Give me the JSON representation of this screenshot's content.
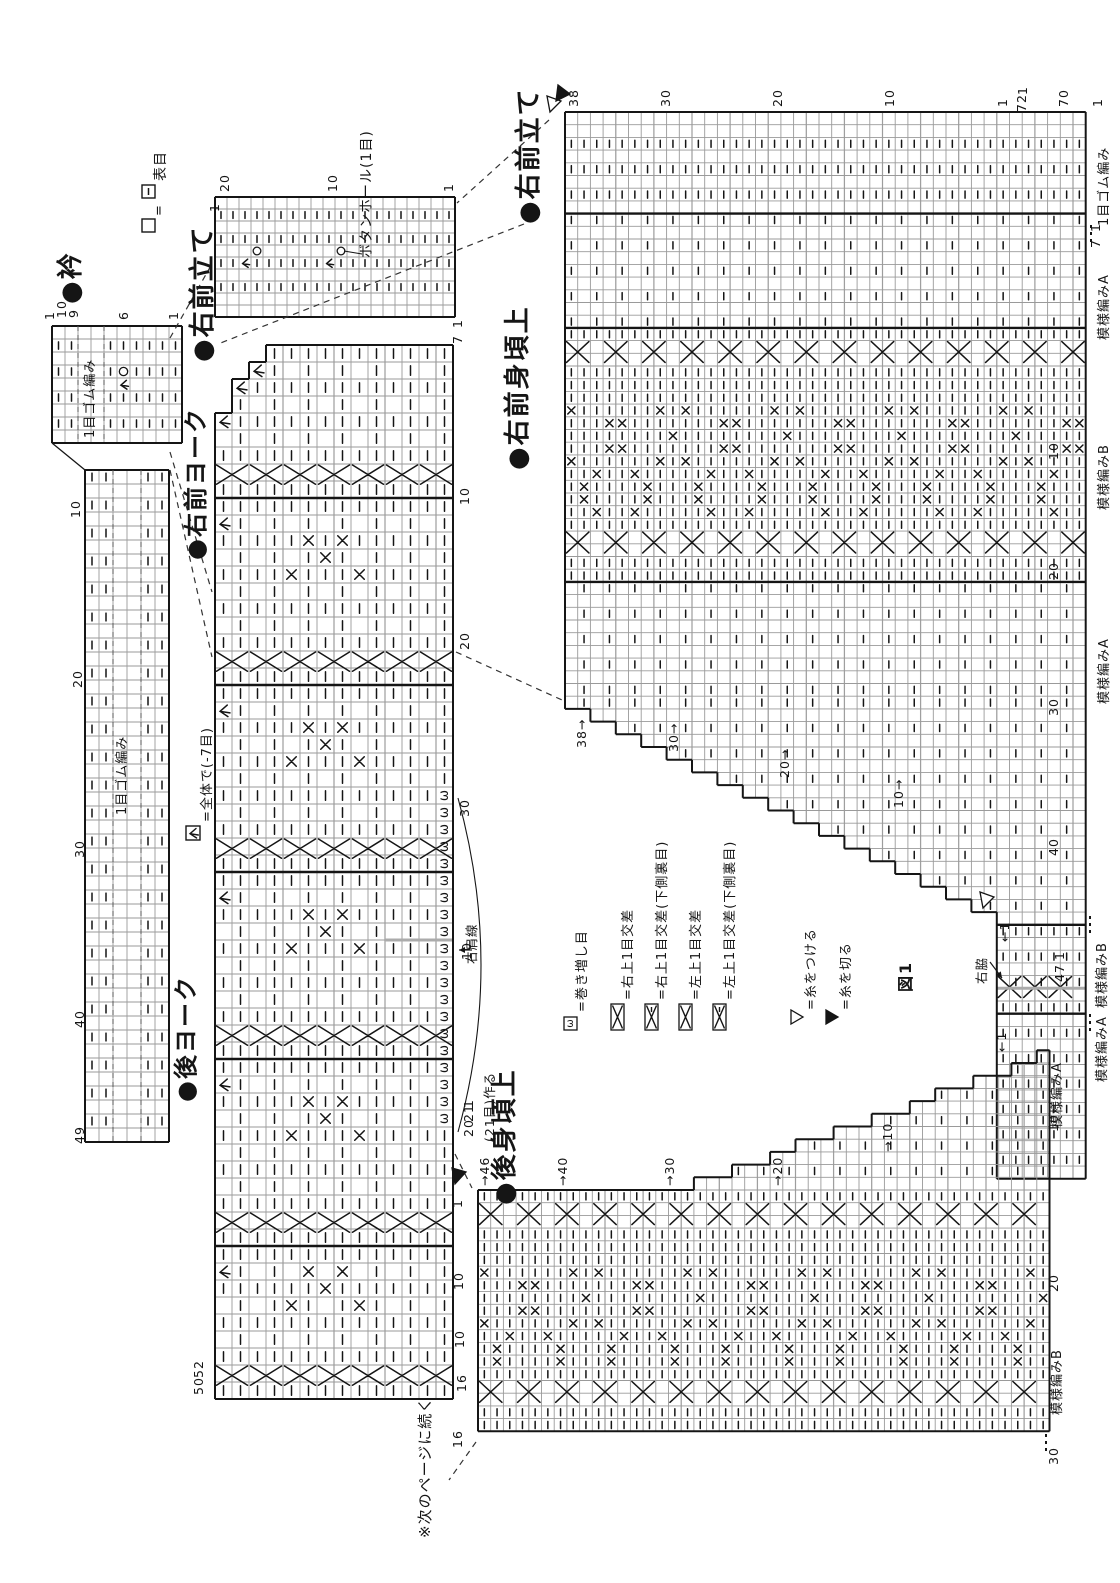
{
  "page": {
    "bg": "#ffffff",
    "ink": "#151515",
    "grid": "#9a9a9a",
    "gray_line": "#bdbdbd",
    "accent_gray": "#b5b5b5"
  },
  "headers": [
    {
      "id": "collar",
      "text": "●衿",
      "x": 58,
      "y": 304,
      "size": 26
    },
    {
      "id": "right-front-band-1",
      "text": "●右前立て",
      "x": 190,
      "y": 362,
      "size": 26
    },
    {
      "id": "right-front-yoke",
      "text": "●右前ヨーク",
      "x": 184,
      "y": 560,
      "size": 24
    },
    {
      "id": "back-yoke",
      "text": "●後ヨーク",
      "x": 174,
      "y": 1102,
      "size": 24
    },
    {
      "id": "right-front-band-2",
      "text": "●右前立て",
      "x": 516,
      "y": 224,
      "size": 26
    },
    {
      "id": "right-front-body-upper",
      "text": "●右前身頃上",
      "x": 505,
      "y": 470,
      "size": 26
    },
    {
      "id": "back-body-upper",
      "text": "●後身頃上",
      "x": 492,
      "y": 1205,
      "size": 26
    }
  ],
  "annotations": [
    {
      "id": "buttonhole",
      "text": "ボタンホール(1目)",
      "x": 360,
      "y": 258,
      "size": 14
    },
    {
      "id": "next-page",
      "text": "※次のページに続く",
      "x": 418,
      "y": 1538,
      "size": 15
    },
    {
      "id": "shoulder-line",
      "text": "右肩線",
      "x": 466,
      "y": 964,
      "size": 12.5
    },
    {
      "id": "make-21",
      "text": "(21目)作る",
      "x": 484,
      "y": 1142,
      "size": 12.5
    },
    {
      "id": "right-side-seam",
      "text": "右脇",
      "x": 976,
      "y": 984,
      "size": 12.5
    },
    {
      "id": "figure-1",
      "text": "図1",
      "x": 898,
      "y": 992,
      "size": 16
    }
  ],
  "section_labels": [
    {
      "text": "1目ゴム編み",
      "x": 1098,
      "y": 226
    },
    {
      "text": "模様編みA",
      "x": 1098,
      "y": 340
    },
    {
      "text": "模様編みB",
      "x": 1098,
      "y": 510
    },
    {
      "text": "模様編みA",
      "x": 1098,
      "y": 704
    },
    {
      "text": "模様編みB",
      "x": 1096,
      "y": 1008
    },
    {
      "text": "模様編みA",
      "x": 1096,
      "y": 1082
    },
    {
      "text": "模様編みA",
      "x": 1051,
      "y": 1128
    },
    {
      "text": "模様編みB",
      "x": 1051,
      "y": 1415
    },
    {
      "text": "1目ゴム編み",
      "x": 84,
      "y": 438
    },
    {
      "text": "1目ゴム編み",
      "x": 116,
      "y": 815
    }
  ],
  "numbers": [
    {
      "t": "1",
      "x": 44,
      "y": 320
    },
    {
      "t": "10",
      "x": 56,
      "y": 318
    },
    {
      "t": "9",
      "x": 68,
      "y": 318
    },
    {
      "t": "6",
      "x": 118,
      "y": 320
    },
    {
      "t": "1",
      "x": 168,
      "y": 320
    },
    {
      "t": "10",
      "x": 70,
      "y": 518
    },
    {
      "t": "20",
      "x": 72,
      "y": 688
    },
    {
      "t": "30",
      "x": 74,
      "y": 858
    },
    {
      "t": "40",
      "x": 74,
      "y": 1028
    },
    {
      "t": "49",
      "x": 74,
      "y": 1144
    },
    {
      "t": "1",
      "x": 209,
      "y": 212
    },
    {
      "t": "20",
      "x": 219,
      "y": 192
    },
    {
      "t": "10",
      "x": 327,
      "y": 192
    },
    {
      "t": "1",
      "x": 443,
      "y": 192
    },
    {
      "t": "1",
      "x": 452,
      "y": 328
    },
    {
      "t": "7",
      "x": 452,
      "y": 344
    },
    {
      "t": "10",
      "x": 459,
      "y": 505
    },
    {
      "t": "20",
      "x": 459,
      "y": 650
    },
    {
      "t": "30",
      "x": 459,
      "y": 817
    },
    {
      "t": "10",
      "x": 461,
      "y": 960
    },
    {
      "t": "1",
      "x": 463,
      "y": 1108
    },
    {
      "t": "21",
      "x": 463,
      "y": 1122
    },
    {
      "t": "20",
      "x": 463,
      "y": 1137
    },
    {
      "t": "52",
      "x": 193,
      "y": 1378
    },
    {
      "t": "50",
      "x": 193,
      "y": 1395
    },
    {
      "t": "38",
      "x": 568,
      "y": 107
    },
    {
      "t": "30",
      "x": 660,
      "y": 107
    },
    {
      "t": "20",
      "x": 772,
      "y": 107
    },
    {
      "t": "10",
      "x": 884,
      "y": 107
    },
    {
      "t": "1",
      "x": 997,
      "y": 107
    },
    {
      "t": "1",
      "x": 1017,
      "y": 95
    },
    {
      "t": "72",
      "x": 1016,
      "y": 112
    },
    {
      "t": "70",
      "x": 1058,
      "y": 107
    },
    {
      "t": "1",
      "x": 1092,
      "y": 107
    },
    {
      "t": "1",
      "x": 1090,
      "y": 232
    },
    {
      "t": "7",
      "x": 1090,
      "y": 248
    },
    {
      "t": "10",
      "x": 1048,
      "y": 460
    },
    {
      "t": "20",
      "x": 1048,
      "y": 580
    },
    {
      "t": "30",
      "x": 1048,
      "y": 716
    },
    {
      "t": "40",
      "x": 1048,
      "y": 856
    },
    {
      "t": "1",
      "x": 1054,
      "y": 960
    },
    {
      "t": "47",
      "x": 1054,
      "y": 982
    },
    {
      "t": "38→",
      "x": 576,
      "y": 748
    },
    {
      "t": "30→",
      "x": 668,
      "y": 752
    },
    {
      "t": "20→",
      "x": 779,
      "y": 778
    },
    {
      "t": "10→",
      "x": 893,
      "y": 808
    },
    {
      "t": "←1",
      "x": 999,
      "y": 942
    },
    {
      "t": "←1",
      "x": 996,
      "y": 1052
    },
    {
      "t": "→46",
      "x": 479,
      "y": 1186
    },
    {
      "t": "→40",
      "x": 557,
      "y": 1186
    },
    {
      "t": "→30",
      "x": 664,
      "y": 1186
    },
    {
      "t": "→20",
      "x": 772,
      "y": 1186
    },
    {
      "t": "→10",
      "x": 882,
      "y": 1152
    },
    {
      "t": "1",
      "x": 452,
      "y": 1208
    },
    {
      "t": "10",
      "x": 453,
      "y": 1290
    },
    {
      "t": "10",
      "x": 454,
      "y": 1348
    },
    {
      "t": "16",
      "x": 456,
      "y": 1392
    },
    {
      "t": "16",
      "x": 452,
      "y": 1448
    },
    {
      "t": "10",
      "x": 1048,
      "y": 1132
    },
    {
      "t": "20",
      "x": 1048,
      "y": 1292
    },
    {
      "t": "30",
      "x": 1048,
      "y": 1465
    }
  ],
  "legend_knit": {
    "eq": "=",
    "text": "表目",
    "box1": {
      "x": 142,
      "y": 219
    },
    "box2": {
      "x": 142,
      "y": 185
    },
    "eq_pos": {
      "x": 153,
      "y": 216
    },
    "text_pos": {
      "x": 154,
      "y": 181
    }
  },
  "legend_dec": {
    "text": "=全体で(-7目)",
    "box": {
      "x": 186,
      "y": 826
    },
    "text_pos": {
      "x": 201,
      "y": 822
    }
  },
  "legend_items": [
    {
      "sym": "omega",
      "text": "=巻き増し目",
      "x": 564
    },
    {
      "sym": "cross",
      "text": "=右上1目交差",
      "x": 611
    },
    {
      "sym": "cross-p",
      "text": "=右上1目交差(下側裏目)",
      "x": 645
    },
    {
      "sym": "cross",
      "text": "=左上1目交差",
      "x": 679
    },
    {
      "sym": "cross-p",
      "text": "=左上1目交差(下側裏目)",
      "x": 713
    },
    {
      "sym": "tri-open",
      "text": "=糸をつける",
      "x": 791
    },
    {
      "sym": "tri-filled",
      "text": "=糸を切る",
      "x": 826
    }
  ],
  "markers": [
    {
      "type": "tri-open",
      "pts": [
        [
          547,
          96
        ],
        [
          561,
          101
        ],
        [
          550,
          112
        ]
      ]
    },
    {
      "type": "tri-filled",
      "pts": [
        [
          556,
          101
        ],
        [
          570,
          94
        ],
        [
          558,
          85
        ]
      ]
    },
    {
      "type": "tri-open",
      "pts": [
        [
          980,
          892
        ],
        [
          994,
          897
        ],
        [
          983,
          908
        ]
      ]
    },
    {
      "type": "tri-filled",
      "pts": [
        [
          452,
          1168
        ],
        [
          466,
          1172
        ],
        [
          455,
          1184
        ]
      ]
    }
  ],
  "dashed_lines": [
    [
      549,
      120,
      457,
      203
    ],
    [
      524,
      224,
      218,
      344
    ],
    [
      170,
      338,
      213,
      262
    ],
    [
      170,
      452,
      212,
      592
    ],
    [
      170,
      470,
      212,
      657
    ],
    [
      456,
      652,
      562,
      700
    ],
    [
      455,
      1154,
      472,
      1188
    ],
    [
      476,
      1442,
      449,
      1480
    ]
  ],
  "leader_lines": [
    [
      362,
      254,
      344,
      251
    ]
  ],
  "dots_marks": [
    [
      1090,
      916,
      1090,
      934
    ],
    [
      1090,
      1014,
      1090,
      1032
    ],
    [
      1046,
      1434,
      1046,
      1452
    ],
    [
      1091,
      225,
      1091,
      243
    ]
  ],
  "curves": [
    {
      "d": "M 458 798 Q 504 965 458 1132"
    }
  ],
  "arrows": [
    {
      "x1": 472,
      "y1": 950,
      "x2": 459,
      "y2": 950
    },
    {
      "x1": 990,
      "y1": 962,
      "x2": 1002,
      "y2": 978
    }
  ],
  "charts": [
    {
      "id": "collar-top",
      "kind": "ribrows",
      "x": 52,
      "y": 326,
      "cell": 13,
      "cols": 10,
      "rows": 9,
      "dashRows": [
        2,
        4,
        6,
        8
      ],
      "gapCols": [
        3,
        4
      ],
      "extras": [
        {
          "c": 6,
          "r": 4,
          "t": "o"
        },
        {
          "c": 6,
          "r": 5,
          "t": "dec"
        }
      ]
    },
    {
      "id": "collar-strip",
      "kind": "strip",
      "x": 85,
      "y": 470,
      "cell": 14,
      "cols": 6,
      "rows": 48
    },
    {
      "id": "front-band",
      "kind": "ribrows",
      "x": 215,
      "y": 197,
      "cell": 12,
      "cols": 20,
      "rows": 10,
      "dashRows": [
        2,
        4,
        6,
        8
      ],
      "gapCols": [],
      "extras": [
        {
          "c": 4,
          "r": 5,
          "t": "o"
        },
        {
          "c": 11,
          "r": 5,
          "t": "o"
        },
        {
          "c": 3,
          "r": 6,
          "t": "dec"
        },
        {
          "c": 10,
          "r": 6,
          "t": "dec"
        }
      ]
    },
    {
      "id": "yoke",
      "kind": "yoke",
      "x": 215,
      "y": 345,
      "cell": 17,
      "cols": 14
    },
    {
      "id": "front-upper",
      "kind": "bigfront",
      "x": 565,
      "y": 112,
      "cell": 12.7,
      "cols": 41
    },
    {
      "id": "back-upper",
      "kind": "backupper",
      "x": 478,
      "y": 1190,
      "cell": 12.7,
      "cols": 45,
      "rows": 19
    }
  ]
}
